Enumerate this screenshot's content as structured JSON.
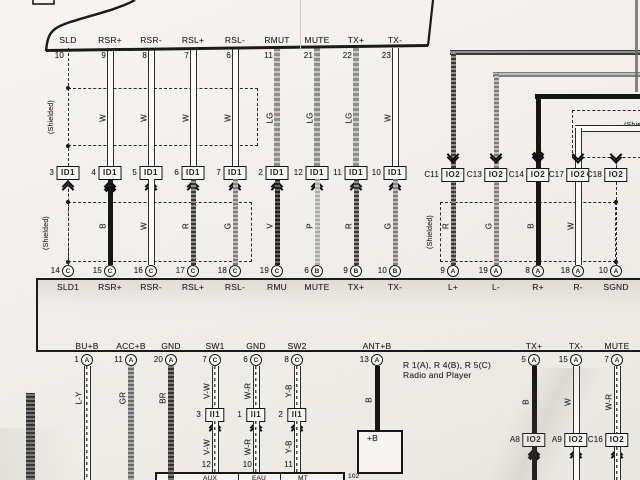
{
  "colors": {
    "paper": "#f2f0ec",
    "ink": "#1f1f1f"
  },
  "labels": {
    "shielded": "(Shielded)",
    "radio_code": "R 1(A), R 4(B), R 5(C)",
    "radio_name": "Radio and Player",
    "antenna_box": "+B",
    "antenna_box_code": "102",
    "bottom_box_cells": [
      "AUX",
      "EAU",
      "MT"
    ]
  },
  "top_connector": {
    "pins": [
      {
        "x": 68,
        "label": "SLD",
        "num": "10"
      },
      {
        "x": 110,
        "label": "RSR+",
        "num": "9"
      },
      {
        "x": 151,
        "label": "RSR-",
        "num": "8"
      },
      {
        "x": 193,
        "label": "RSL+",
        "num": "7"
      },
      {
        "x": 235,
        "label": "RSL-",
        "num": "6"
      },
      {
        "x": 277,
        "label": "RMUT",
        "num": "11"
      },
      {
        "x": 317,
        "label": "MUTE",
        "num": "21"
      },
      {
        "x": 356,
        "label": "TX+",
        "num": "22"
      },
      {
        "x": 395,
        "label": "TX-",
        "num": "23"
      }
    ]
  },
  "main_columns": [
    {
      "x": 68,
      "upper": "SHIELD",
      "mid_pin": "3",
      "mid_code": "ID1",
      "lower": "SHIELD",
      "pin_num": "14",
      "pin_letter": "C",
      "pin_label": "SLD1"
    },
    {
      "x": 110,
      "upper": "W",
      "mid_pin": "4",
      "mid_code": "ID1",
      "lower": "B",
      "pin_num": "15",
      "pin_letter": "C",
      "pin_label": "RSR+"
    },
    {
      "x": 151,
      "upper": "W",
      "mid_pin": "5",
      "mid_code": "ID1",
      "lower": "W",
      "pin_num": "16",
      "pin_letter": "C",
      "pin_label": "RSR-"
    },
    {
      "x": 193,
      "upper": "W",
      "mid_pin": "6",
      "mid_code": "ID1",
      "lower": "R",
      "pin_num": "17",
      "pin_letter": "C",
      "pin_label": "RSL+"
    },
    {
      "x": 235,
      "upper": "W",
      "mid_pin": "7",
      "mid_code": "ID1",
      "lower": "G",
      "pin_num": "18",
      "pin_letter": "C",
      "pin_label": "RSL-"
    },
    {
      "x": 277,
      "upper": "LG",
      "mid_pin": "2",
      "mid_code": "ID1",
      "lower": "V",
      "pin_num": "19",
      "pin_letter": "C",
      "pin_label": "RMU"
    },
    {
      "x": 317,
      "upper": "LG",
      "mid_pin": "12",
      "mid_code": "ID1",
      "lower": "P",
      "pin_num": "6",
      "pin_letter": "B",
      "pin_label": "MUTE"
    },
    {
      "x": 356,
      "upper": "LG",
      "mid_pin": "11",
      "mid_code": "ID1",
      "lower": "R",
      "pin_num": "9",
      "pin_letter": "B",
      "pin_label": "TX+"
    },
    {
      "x": 395,
      "upper": "W",
      "mid_pin": "10",
      "mid_code": "ID1",
      "lower": "G",
      "pin_num": "10",
      "pin_letter": "B",
      "pin_label": "TX-"
    }
  ],
  "right_columns": [
    {
      "x": 453,
      "bend_y": 52,
      "wire": "R",
      "mid_pin": "C11",
      "mid_code": "IO2",
      "lower": "R",
      "pin_num": "9",
      "pin_letter": "A",
      "pin_label": "L+"
    },
    {
      "x": 496,
      "bend_y": 74,
      "wire": "G",
      "mid_pin": "C13",
      "mid_code": "IO2",
      "lower": "G",
      "pin_num": "19",
      "pin_letter": "A",
      "pin_label": "L-"
    },
    {
      "x": 538,
      "bend_y": 96,
      "wire": "B",
      "mid_pin": "C14",
      "mid_code": "IO2",
      "lower": "B",
      "pin_num": "8",
      "pin_letter": "A",
      "pin_label": "R+"
    },
    {
      "x": 578,
      "bend_y": 128,
      "wire": "W",
      "mid_pin": "C17",
      "mid_code": "IO2",
      "lower": "W",
      "pin_num": "18",
      "pin_letter": "A",
      "pin_label": "R-"
    },
    {
      "x": 616,
      "bend_y": null,
      "wire": "SHIELD",
      "mid_pin": "C18",
      "mid_code": "IO2",
      "lower": "SHIELD",
      "pin_num": "10",
      "pin_letter": "A",
      "pin_label": "SGND"
    }
  ],
  "bottom_columns": [
    {
      "x": 87,
      "label": "BU+B",
      "pin_num": "1",
      "pin_letter": "A",
      "wire": "L-Y"
    },
    {
      "x": 131,
      "label": "ACC+B",
      "pin_num": "11",
      "pin_letter": "A",
      "wire": "GR"
    },
    {
      "x": 171,
      "label": "GND",
      "pin_num": "20",
      "pin_letter": "A",
      "wire": "BR"
    },
    {
      "x": 215,
      "label": "SW1",
      "pin_num": "7",
      "pin_letter": "C",
      "wire": "V-W",
      "mid_pin": "3",
      "mid_code": "II1",
      "lower": "V-W",
      "bottom_num": "12"
    },
    {
      "x": 256,
      "label": "GND",
      "pin_num": "6",
      "pin_letter": "C",
      "wire": "W-R",
      "mid_pin": "1",
      "mid_code": "II1",
      "lower": "W-R",
      "bottom_num": "10"
    },
    {
      "x": 297,
      "label": "SW2",
      "pin_num": "8",
      "pin_letter": "C",
      "wire": "Y-B",
      "mid_pin": "2",
      "mid_code": "II1",
      "lower": "Y-B",
      "bottom_num": "11"
    },
    {
      "x": 377,
      "label": "ANT+B",
      "pin_num": "13",
      "pin_letter": "A",
      "wire": "B",
      "target": "antenna"
    },
    {
      "x": 534,
      "label": "TX+",
      "pin_num": "5",
      "pin_letter": "A",
      "wire": "B",
      "end_pin": "A8",
      "end_code": "IO2"
    },
    {
      "x": 576,
      "label": "TX-",
      "pin_num": "15",
      "pin_letter": "A",
      "wire": "W",
      "end_pin": "A9",
      "end_code": "IO2"
    },
    {
      "x": 617,
      "label": "MUTE",
      "pin_num": "7",
      "pin_letter": "A",
      "wire": "W-R",
      "end_pin": "C16",
      "end_code": "IO2"
    }
  ]
}
